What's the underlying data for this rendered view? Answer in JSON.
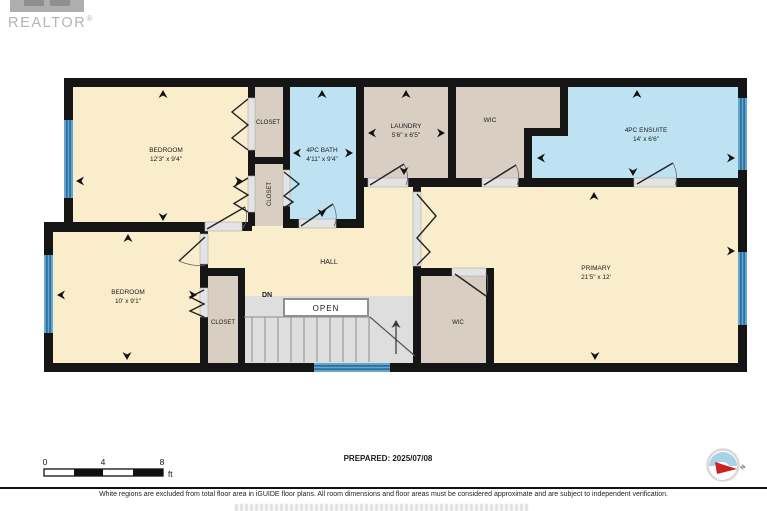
{
  "branding": {
    "wordmark": "REALTOR",
    "registered": "®"
  },
  "plan": {
    "rooms": {
      "bedroom1": {
        "name": "BEDROOM",
        "dims": "12'3\" x 9'4\""
      },
      "closet_a": {
        "name": "CLOSET"
      },
      "closet_b": {
        "name": "CLOSET"
      },
      "bath": {
        "name": "4PC BATH",
        "dims": "4'11\" x 9'4\""
      },
      "laundry": {
        "name": "LAUNDRY",
        "dims": "5'6\" x 6'5\""
      },
      "wic_top": {
        "name": "WIC"
      },
      "ensuite": {
        "name": "4PC ENSUITE",
        "dims": "14' x 6'6\""
      },
      "hall": {
        "name": "HALL"
      },
      "primary": {
        "name": "PRIMARY",
        "dims": "21'5\" x 12'"
      },
      "wic_bottom": {
        "name": "WIC"
      },
      "closet_c": {
        "name": "CLOSET"
      },
      "bedroom2": {
        "name": "BEDROOM",
        "dims": "10' x 9'1\""
      }
    },
    "labels": {
      "dn": "DN",
      "open": "OPEN"
    },
    "colors": {
      "room_cream": "#F9EDCB",
      "room_tan": "#D8CEC1",
      "room_blue": "#BEE2F2",
      "stairs_gray": "#DEDEDE",
      "wall": "#151515",
      "window_blue": "#62A7D2",
      "window_dark": "#24618C"
    }
  },
  "scale_bar": {
    "tick_0": "0",
    "tick_4": "4",
    "tick_8": "8",
    "unit": "ft"
  },
  "compass": {
    "north_label": "N"
  },
  "footer": {
    "prepared": "PREPARED: 2025/07/08",
    "disclaimer": "White regions are excluded from total floor area in iGUIDE floor plans. All room dimensions and floor areas must be considered approximate and are subject to independent verification."
  }
}
